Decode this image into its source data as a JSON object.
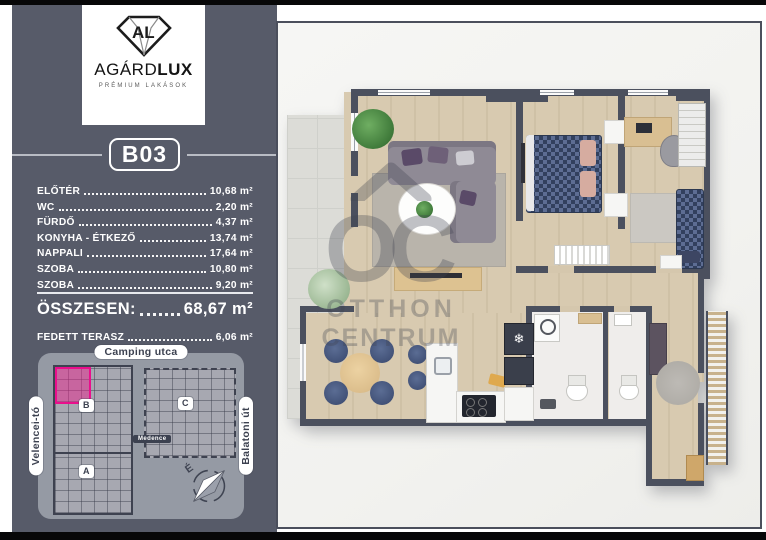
{
  "brand": {
    "monogram": "AL",
    "name_regular": "AGÁRD",
    "name_bold": "LUX",
    "tagline": "PRÉMIUM LAKÁSOK"
  },
  "unit": {
    "code": "B03"
  },
  "rooms": [
    {
      "name": "ELŐTÉR",
      "area": "10,68 m²"
    },
    {
      "name": "WC",
      "area": "2,20 m²"
    },
    {
      "name": "FÜRDŐ",
      "area": "4,37 m²"
    },
    {
      "name": "KONYHA - ÉTKEZŐ",
      "area": "13,74 m²"
    },
    {
      "name": "NAPPALI",
      "area": "17,64 m²"
    },
    {
      "name": "SZOBA",
      "area": "10,80 m²"
    },
    {
      "name": "SZOBA",
      "area": "9,20 m²"
    }
  ],
  "total": {
    "label": "ÖSSZESEN:",
    "value": "68,67 m²"
  },
  "covered_terrace": {
    "label": "FEDETT TERASZ",
    "value": "6,06 m²"
  },
  "site_map": {
    "street_top": "Camping utca",
    "waterfront_left": "Velencei-tó",
    "street_right": "Balatoni út",
    "pool": "Medence",
    "building_b": "B",
    "building_c": "C",
    "building_a": "A",
    "compass_north": "É"
  },
  "watermark": {
    "monogram": "OC",
    "line1": "OTTHON",
    "line2": "CENTRUM"
  },
  "colors": {
    "accent_pink": "#ea0e8c",
    "sidebar_gray": "#575b69",
    "wall_dark": "#4b505e",
    "floor_wood": "#d5c7ad",
    "bed_navy": "#32405e"
  }
}
